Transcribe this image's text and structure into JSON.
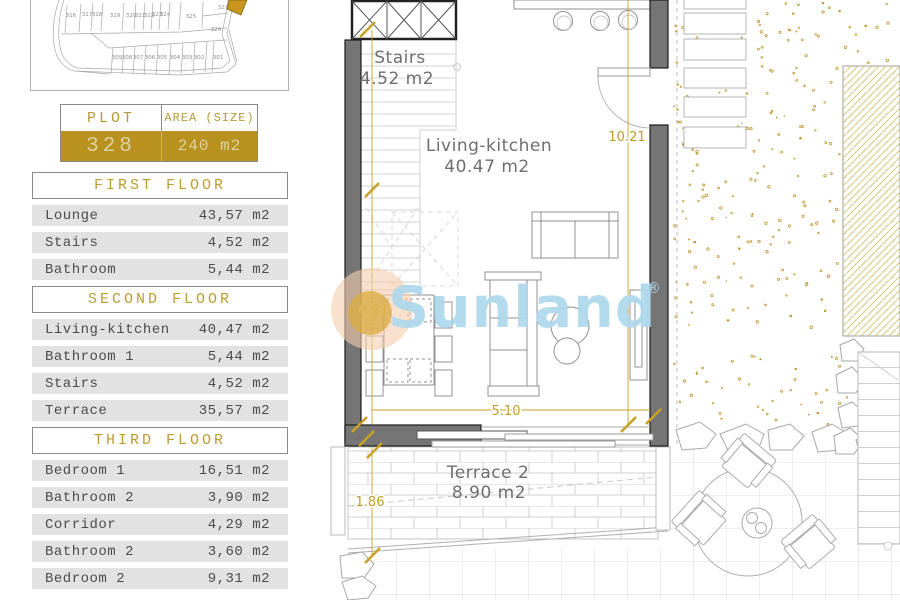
{
  "site_plan": {
    "top_plots": [
      "316",
      "317",
      "318",
      "319",
      "320",
      "321",
      "322",
      "323",
      "324",
      "325"
    ],
    "corner_plots": [
      "327",
      "326"
    ],
    "bottom_plots": [
      "309",
      "308",
      "307",
      "306",
      "305",
      "304",
      "303",
      "302",
      "301"
    ],
    "highlighted_plot": "328"
  },
  "plot_table": {
    "plot_header": "PLOT",
    "area_header": "AREA (SIZE)",
    "plot_number": "328",
    "area_value": "240 m2"
  },
  "floors": [
    {
      "title": "FIRST FLOOR",
      "rows": [
        [
          "Lounge",
          "43,57 m2"
        ],
        [
          "Stairs",
          "4,52 m2"
        ],
        [
          "Bathroom",
          "5,44 m2"
        ]
      ]
    },
    {
      "title": "SECOND FLOOR",
      "rows": [
        [
          "Living-kitchen",
          "40,47 m2"
        ],
        [
          "Bathroom 1",
          "5,44 m2"
        ],
        [
          "Stairs",
          "4,52 m2"
        ],
        [
          "Terrace",
          "35,57 m2"
        ]
      ]
    },
    {
      "title": "THIRD FLOOR",
      "rows": [
        [
          "Bedroom 1",
          "16,51 m2"
        ],
        [
          "Bathroom 2",
          "3,90 m2"
        ],
        [
          "Corridor",
          "4,29 m2"
        ],
        [
          "Bathroom 2",
          "3,60 m2"
        ],
        [
          "Bedroom 2",
          "9,31 m2"
        ]
      ]
    }
  ],
  "plan": {
    "rooms": [
      {
        "name": "Stairs",
        "area": "4.52 m2"
      },
      {
        "name": "Living-kitchen",
        "area": "40.47 m2"
      },
      {
        "name": "Terrace 2",
        "area": "8.90 m2"
      }
    ],
    "dimensions": {
      "right_height": "10.21",
      "living_height": "4.21",
      "living_width": "5.10",
      "terrace_depth": "1.86"
    }
  },
  "watermark": {
    "text": "Sunland",
    "reg": "®"
  },
  "colors": {
    "accent_gold": "#b8911f",
    "dim_gold": "#c49d25",
    "wall_gray": "#757575",
    "row_gray": "#e2e2e2",
    "watermark_blue": "#aed8ec",
    "highlight_plot": "#c8961e"
  }
}
